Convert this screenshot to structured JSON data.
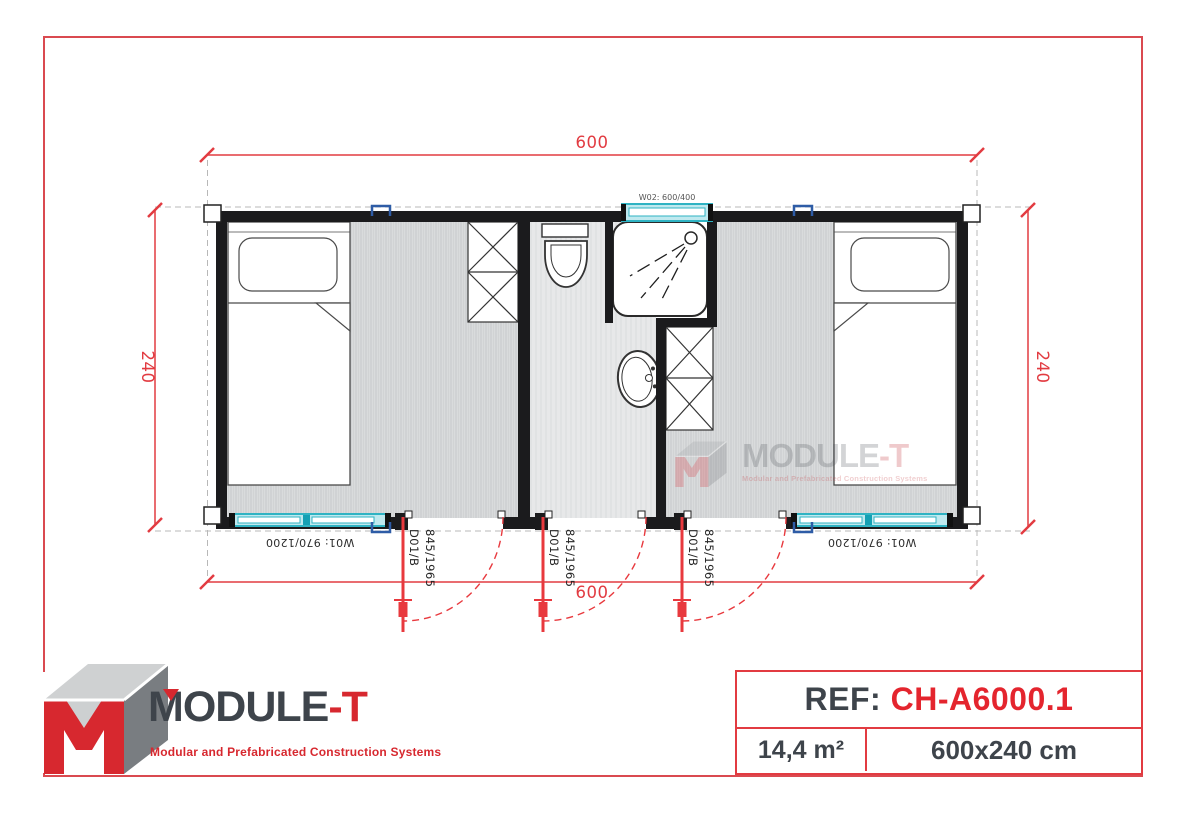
{
  "plan": {
    "dim_top": "600",
    "dim_bottom": "600",
    "dim_left": "240",
    "dim_right": "240",
    "window_top_label": "W02: 600/400",
    "window_bottom_label": "W01: 970/1200",
    "door_code": "D01/B",
    "door_size": "845/1965"
  },
  "watermark": {
    "brand_main": "MODULE",
    "brand_suffix": "-T",
    "tagline": "Modular and Prefabricated Construction Systems"
  },
  "logo": {
    "brand_main": "MODULE",
    "brand_suffix": "-T",
    "tagline": "Modular and Prefabricated Construction Systems"
  },
  "ref": {
    "label": "REF: ",
    "code": "CH-A6000.1",
    "area": "14,4 m²",
    "size": "600x240 cm"
  },
  "colors": {
    "dimension_red": "#E23B41",
    "brand_red": "#D7282F",
    "ref_code_red": "#E4252E",
    "dark_text": "#3E444B",
    "wall_black": "#1B1B1D",
    "window_cyan": "#2FB3C3",
    "clip_blue": "#2E5CA6",
    "border_red": "#DA4A50"
  }
}
